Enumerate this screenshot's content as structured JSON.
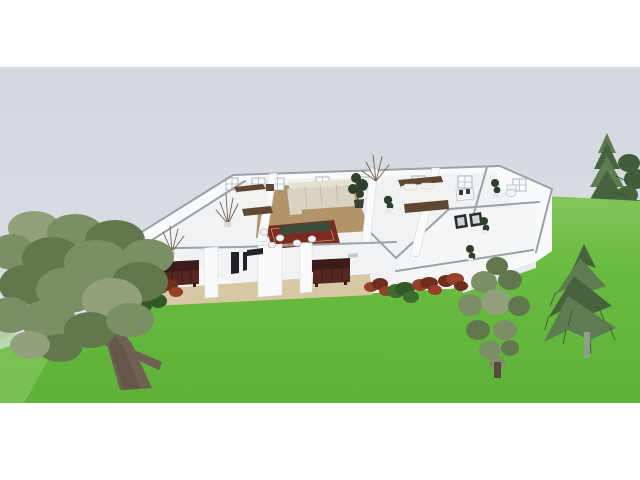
{
  "view": {
    "kind": "3d-home-design-render",
    "letterbox": {
      "top_margin_px": 67,
      "bottom_margin_px": 77,
      "viewport_height_px": 336
    }
  },
  "scene": {
    "objects": [
      {
        "name": "sky",
        "label": "overcast gray sky"
      },
      {
        "name": "lawn",
        "label": "green grass terrain"
      },
      {
        "name": "house",
        "label": "single-story house cutaway with furnished rooms"
      },
      {
        "name": "living-room",
        "label": "living room with cream sectional sofa, wood floor, red rug, dining set"
      },
      {
        "name": "bedroom-left",
        "label": "bedroom with wood-frame bed"
      },
      {
        "name": "bedroom-right",
        "label": "bedroom with wood-frame double bed"
      },
      {
        "name": "bathroom",
        "label": "bathroom with white fixtures"
      },
      {
        "name": "porch",
        "label": "front porch with two maroon benches and dark doorways"
      },
      {
        "name": "shrubs",
        "label": "red and green shrubs along facade"
      },
      {
        "name": "deciduous-tree",
        "label": "large low-poly deciduous tree, foreground left"
      },
      {
        "name": "round-shrub-tree",
        "label": "rounded topiary-like tree right of house"
      },
      {
        "name": "drooping-spruce",
        "label": "drooping spruce right side"
      },
      {
        "name": "fir-tree",
        "label": "fir tree upper right"
      },
      {
        "name": "dark-conifer",
        "label": "dark conifer at right edge"
      }
    ]
  },
  "colors": {
    "margin_white": "#ffffff",
    "sky_top": "#d2d8de",
    "sky_bottom": "#dde2e6",
    "lawn_light": "#85c75c",
    "lawn_main": "#68bc3e",
    "lawn_dark": "#5bb135",
    "lawn_patch": "#9ad172",
    "terrain_gray": "#bfc9c3",
    "wall_white": "#f9fafb",
    "wall_shade": "#e7eaec",
    "wall_cap": "#9aa1a8",
    "floor_light": "#f1f2f3",
    "floor_wing": "#f4f5f5",
    "floor_wood": "#b3946a",
    "floor_porch": "#d8c7a3",
    "rug_red": "#7b2b21",
    "sofa_cream": "#d9d3c1",
    "sofa_cream_light": "#e6e0cf",
    "bench_maroon": "#552722",
    "bench_maroon_dark": "#3c1b18",
    "bed_wood": "#5f4733",
    "bed_linen": "#f3f2ee",
    "table_green": "#3c4c38",
    "door_dark": "#222228",
    "plant_dark": "#2e402c",
    "pot_white": "#e8e8e6",
    "dried_branch": "#71604f",
    "bush_red": "#95412a",
    "bush_red_dark": "#6f2d1d",
    "bush_green": "#3e6b2e",
    "tree_green": "#7b8e66",
    "tree_green_dark": "#63774f",
    "tree_green_light": "#90a17c",
    "trunk_brown": "#6f6054",
    "trunk_dark": "#59493f",
    "pine_green": "#5e7c51",
    "pine_dark": "#47633e",
    "pine_pale": "#8e9e88",
    "conifer_dark": "#415c3a",
    "step_gray": "#c8cbcd",
    "fixture_white": "#f2f3f3"
  }
}
